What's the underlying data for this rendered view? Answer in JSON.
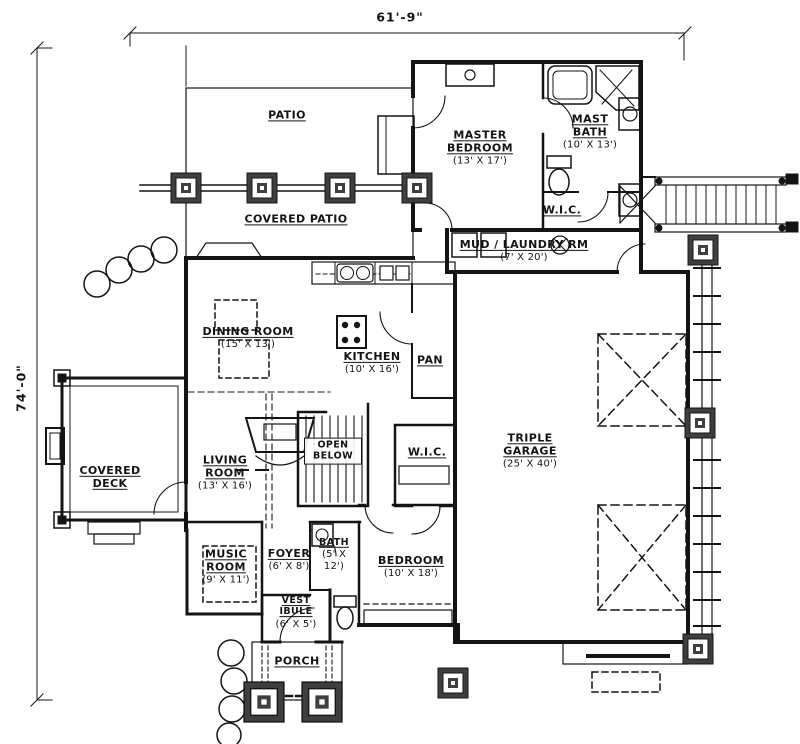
{
  "drawing": {
    "type": "house-floor-plan"
  },
  "dimensions": {
    "width_label": "61'-9\"",
    "height_label": "74'-0\""
  },
  "rooms": {
    "patio": {
      "name": "PATIO"
    },
    "covered_patio": {
      "name": "COVERED PATIO"
    },
    "master_bedroom": {
      "name": "MASTER BEDROOM",
      "dims": "(13' X 17')"
    },
    "mast_bath": {
      "name": "MAST BATH",
      "dims": "(10' X 13')"
    },
    "wic_master": {
      "name": "W.I.C."
    },
    "mud_laundry": {
      "name": "MUD / LAUNDRY RM",
      "dims": "(7' X 20')"
    },
    "dining_room": {
      "name": "DINING ROOM",
      "dims": "(15' X 13')"
    },
    "kitchen": {
      "name": "KITCHEN",
      "dims": "(10' X 16')"
    },
    "pantry": {
      "name": "PAN"
    },
    "triple_garage": {
      "name": "TRIPLE GARAGE",
      "dims": "(25' X 40')"
    },
    "covered_deck": {
      "name": "COVERED DECK"
    },
    "living_room": {
      "name": "LIVING ROOM",
      "dims": "(13' X 16')"
    },
    "open_below": {
      "name": "OPEN BELOW"
    },
    "wic_stairs": {
      "name": "W.I.C."
    },
    "music_room": {
      "name": "MUSIC ROOM",
      "dims": "(9' X 11')"
    },
    "foyer": {
      "name": "FOYER",
      "dims": "(6' X 8')"
    },
    "bath": {
      "name": "BATH",
      "dims": "(5' X 12')"
    },
    "bedroom": {
      "name": "BEDROOM",
      "dims": "(10' X 18')"
    },
    "vestibule": {
      "name": "VEST IBULE",
      "dims": "(6' X 5')"
    },
    "porch": {
      "name": "PORCH"
    }
  },
  "colors": {
    "ink": "#141414",
    "paper": "#ffffff"
  }
}
